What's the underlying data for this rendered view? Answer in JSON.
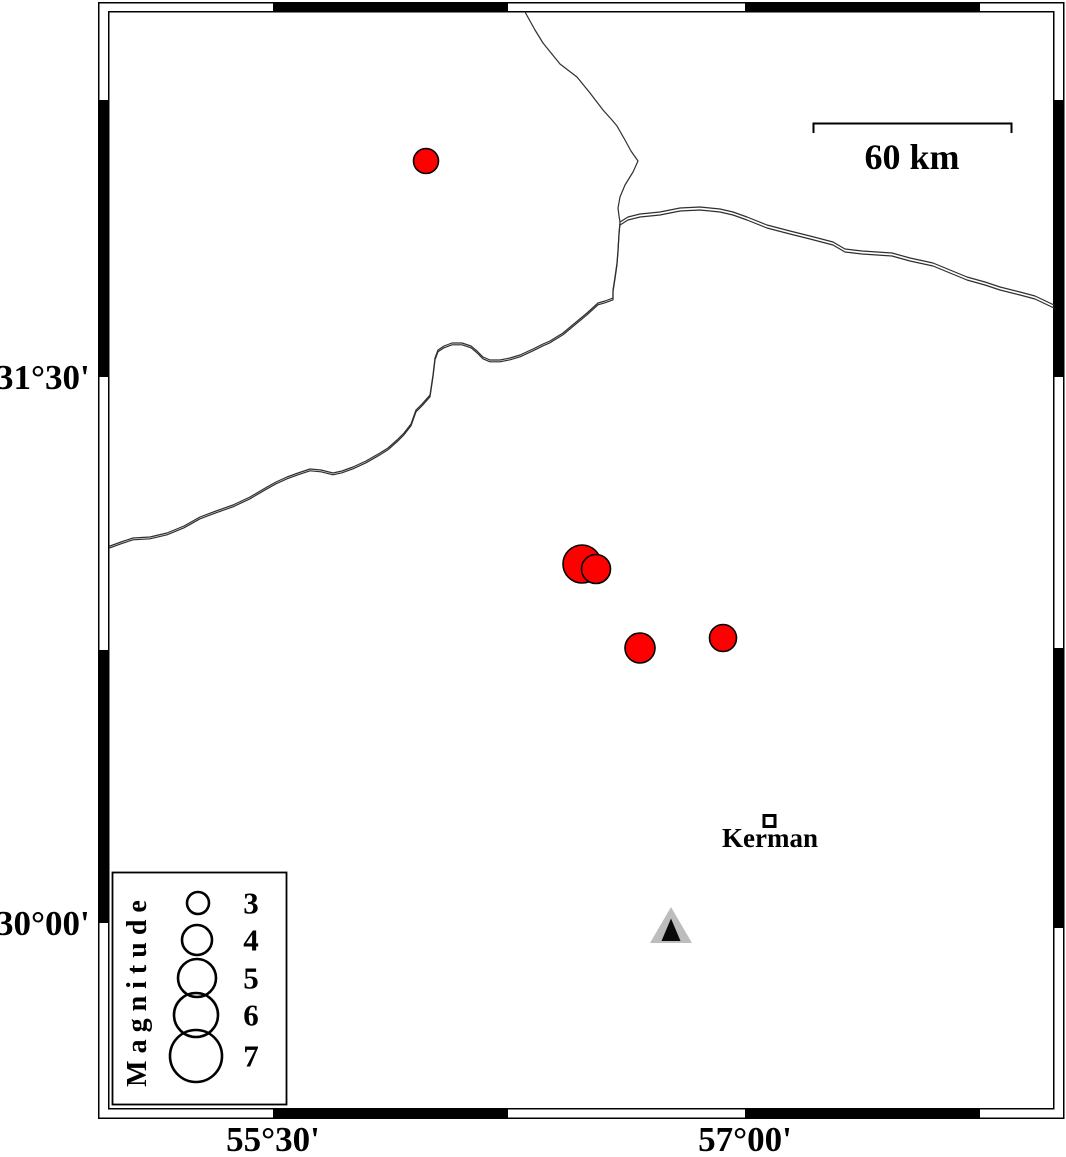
{
  "axes": {
    "left": [
      {
        "label": "31°30'",
        "y": 377
      },
      {
        "label": "30°00'",
        "y": 923
      }
    ],
    "bottom": [
      {
        "label": "55°30'",
        "x": 273
      },
      {
        "label": "57°00'",
        "x": 745
      }
    ]
  },
  "scale_bar": {
    "label": "60 km"
  },
  "cities": [
    {
      "name": "Kerman",
      "x": 769,
      "y": 821
    }
  ],
  "station_marker": {
    "type": "triangle",
    "x": 671,
    "y": 928
  },
  "earthquakes": [
    {
      "x": 426,
      "y": 161,
      "r": 12.5,
      "magnitude_approx": 3.4
    },
    {
      "x": 582,
      "y": 564,
      "r": 19,
      "magnitude_approx": 5.0
    },
    {
      "x": 596,
      "y": 569,
      "r": 14.5,
      "magnitude_approx": 3.9
    },
    {
      "x": 640,
      "y": 648,
      "r": 15,
      "magnitude_approx": 4.0
    },
    {
      "x": 723,
      "y": 638,
      "r": 13.5,
      "magnitude_approx": 3.6
    }
  ],
  "legend": {
    "title": "Magnitude",
    "entries": [
      {
        "label": "3",
        "r": 11,
        "cx": 198,
        "cy": 903,
        "label_x": 251
      },
      {
        "label": "4",
        "r": 15,
        "cx": 197,
        "cy": 940,
        "label_x": 251
      },
      {
        "label": "5",
        "r": 19,
        "cx": 197,
        "cy": 978,
        "label_x": 251
      },
      {
        "label": "6",
        "r": 22,
        "cx": 196,
        "cy": 1015,
        "label_x": 251
      },
      {
        "label": "7",
        "r": 26,
        "cx": 196,
        "cy": 1056,
        "label_x": 251
      }
    ]
  },
  "colors": {
    "earthquake_fill": "#ff0000",
    "station_gray": "#bdbdbd",
    "line": "#2f2f2f"
  }
}
